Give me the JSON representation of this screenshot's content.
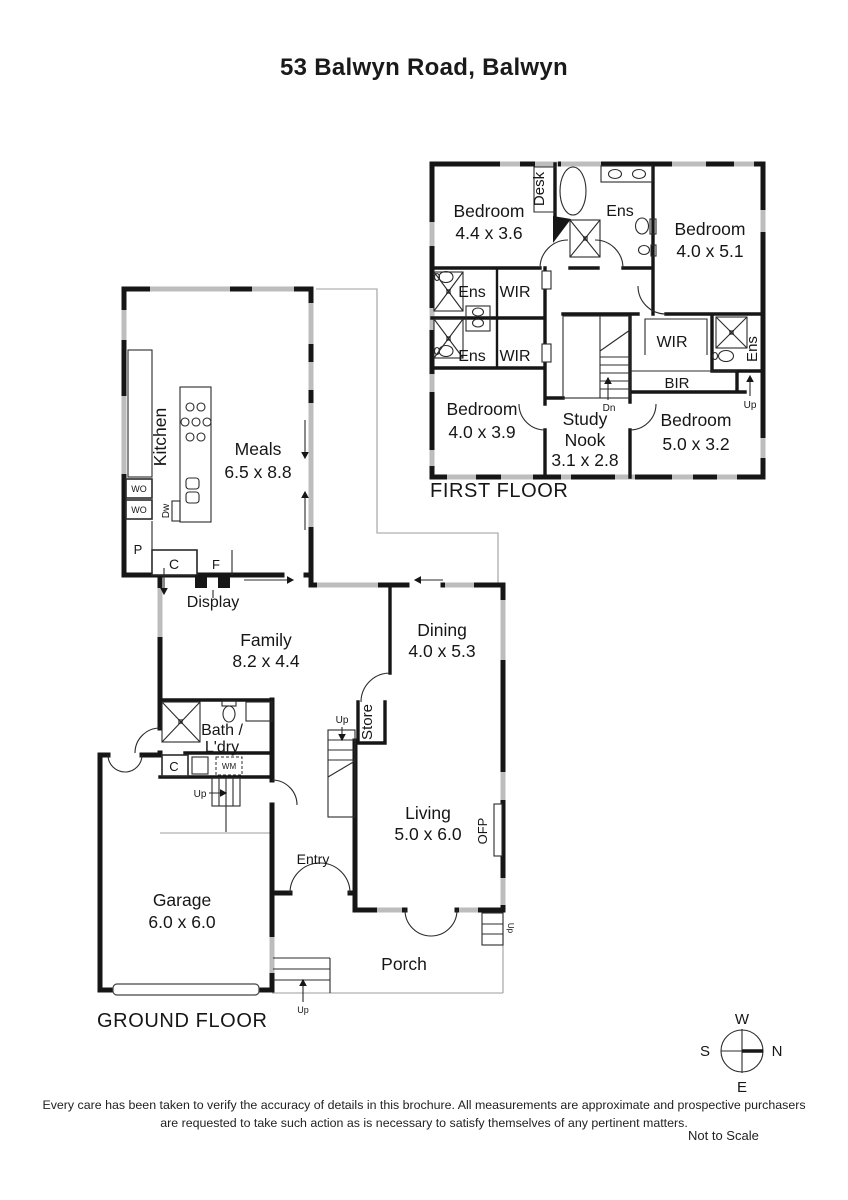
{
  "title": "53 Balwyn Road, Balwyn",
  "first_floor": {
    "floor_label": "FIRST FLOOR",
    "bedroom_tl": {
      "name": "Bedroom",
      "dims": "4.4 x 3.6"
    },
    "bedroom_tr": {
      "name": "Bedroom",
      "dims": "4.0 x 5.1"
    },
    "bedroom_bl": {
      "name": "Bedroom",
      "dims": "4.0 x 3.9"
    },
    "bedroom_br": {
      "name": "Bedroom",
      "dims": "5.0 x 3.2"
    },
    "study_nook": {
      "line1": "Study",
      "line2": "Nook",
      "dims": "3.1 x 2.8"
    },
    "desk": "Desk",
    "ens": "Ens",
    "wir": "WIR",
    "bir": "BIR",
    "up": "Up",
    "dn": "Dn"
  },
  "ground_floor": {
    "floor_label": "GROUND FLOOR",
    "kitchen": "Kitchen",
    "meals": {
      "name": "Meals",
      "dims": "6.5 x 8.8"
    },
    "family": {
      "name": "Family",
      "dims": "8.2 x 4.4"
    },
    "dining": {
      "name": "Dining",
      "dims": "4.0 x 5.3"
    },
    "living": {
      "name": "Living",
      "dims": "5.0 x 6.0"
    },
    "garage": {
      "name": "Garage",
      "dims": "6.0 x 6.0"
    },
    "bath": {
      "line1": "Bath /",
      "line2": "L'dry"
    },
    "display": "Display",
    "entry": "Entry",
    "porch": "Porch",
    "store": "Store",
    "ofp": "OFP",
    "wo": "WO",
    "p": "P",
    "c": "C",
    "f": "F",
    "wm": "WM",
    "dw": "Dw",
    "up": "Up"
  },
  "compass": {
    "n": "N",
    "s": "S",
    "e": "E",
    "w": "W"
  },
  "footer": {
    "line1": "Every care has been taken to verify the accuracy of details in this brochure. All measurements are approximate and prospective purchasers",
    "line2": "are requested to take such action as is necessary to satisfy themselves of any pertinent matters.",
    "scale": "Not to Scale"
  }
}
